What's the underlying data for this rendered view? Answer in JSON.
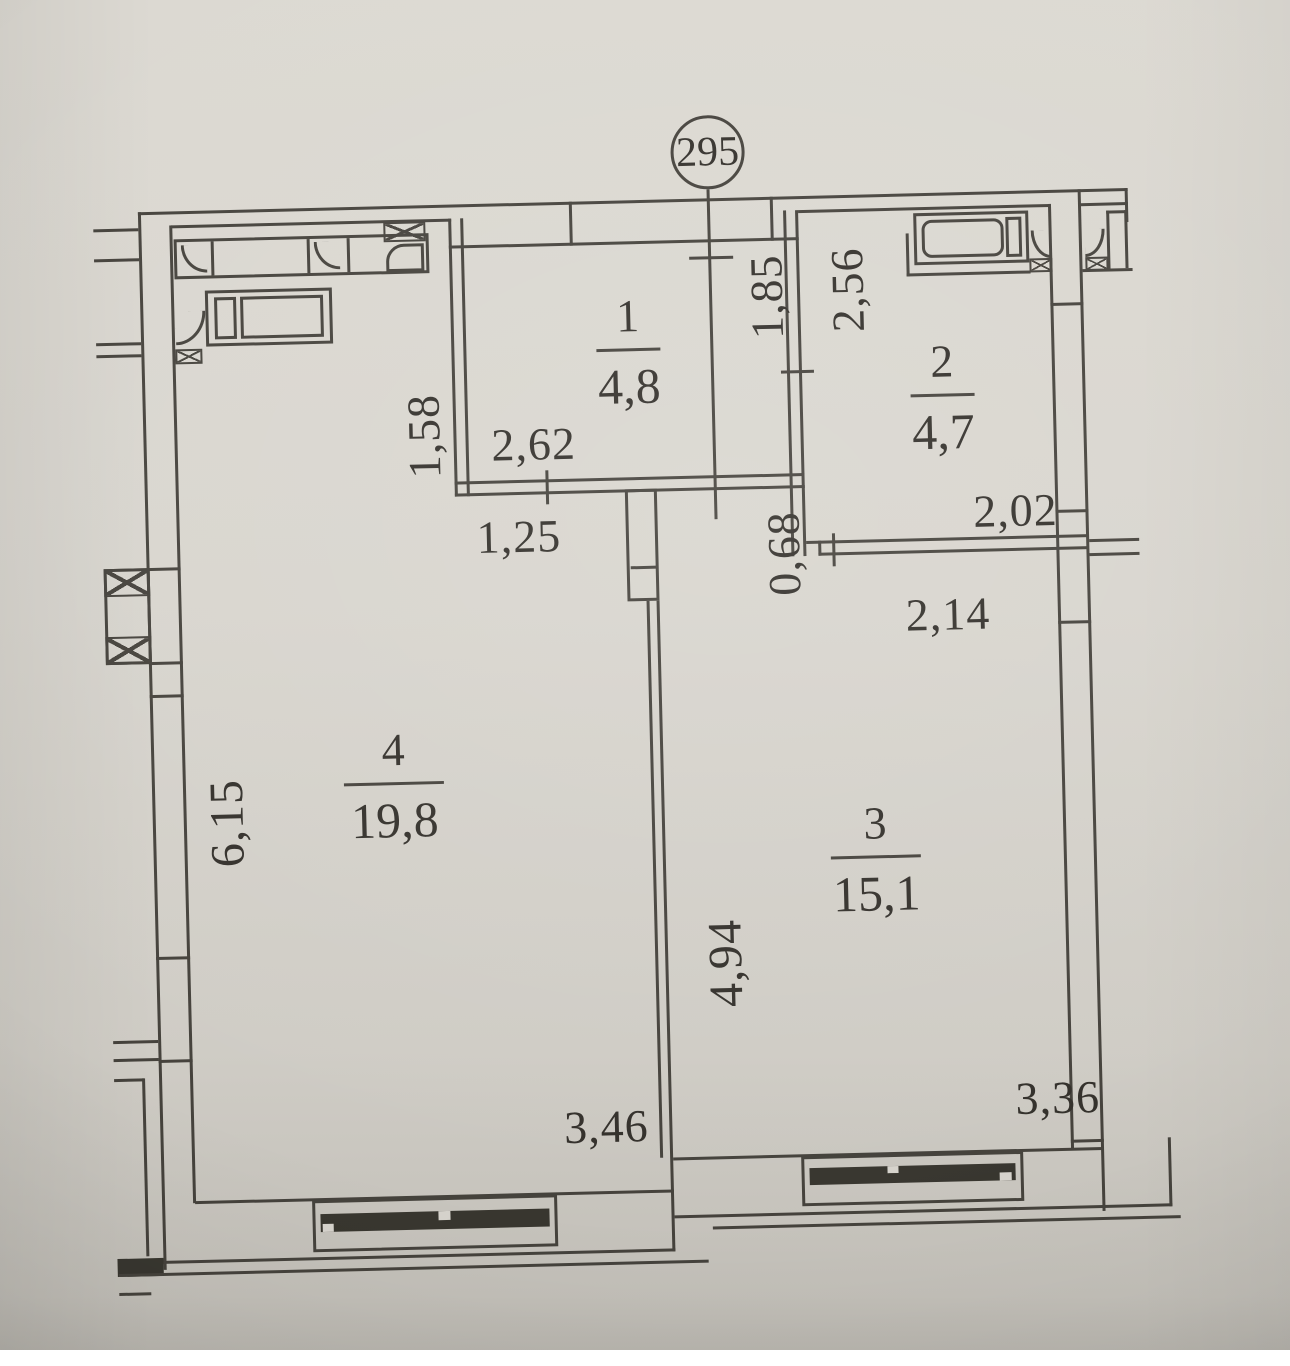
{
  "sheet": {
    "plan_number": "295"
  },
  "rooms": [
    {
      "number": "1",
      "area": "4,8"
    },
    {
      "number": "2",
      "area": "4,7"
    },
    {
      "number": "3",
      "area": "15,1"
    },
    {
      "number": "4",
      "area": "19,8"
    }
  ],
  "dims": {
    "room1_width": "2,62",
    "room1_depth": "1,85",
    "passage": "1,25",
    "kitchen_side": "1,58",
    "room2_depth": "2,56",
    "room2_width": "2,02",
    "offset": "0,68",
    "room3_top": "2,14",
    "room4_side": "6,15",
    "room3_side": "4,94",
    "room4_bottom": "3,46",
    "room3_bottom": "3,36"
  },
  "colors": {
    "paper": "#d6d3cc",
    "line": "#45423c",
    "text": "#33302b",
    "glazing": "#38362f"
  }
}
